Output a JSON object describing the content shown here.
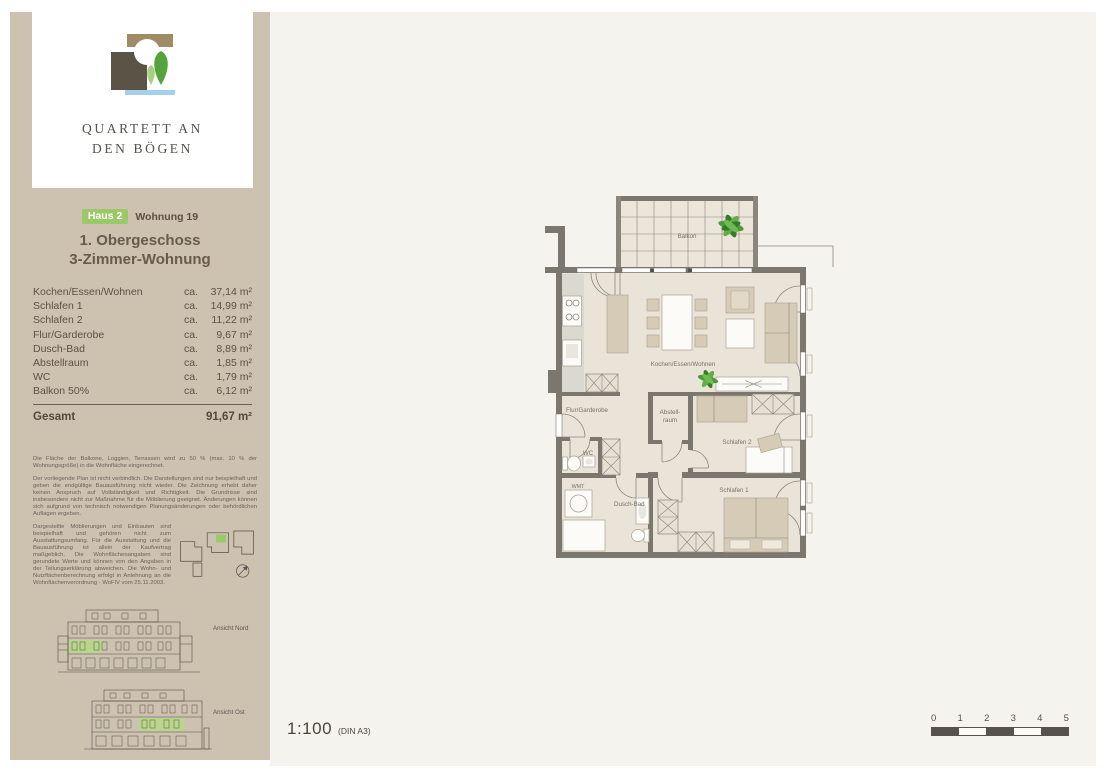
{
  "brand": {
    "name_line1": "QUARTETT AN",
    "name_line2": "DEN BÖGEN"
  },
  "header": {
    "house_badge": "Haus 2",
    "unit": "Wohnung 19",
    "floor": "1. Obergeschoss",
    "type": "3-Zimmer-Wohnung"
  },
  "area_table": {
    "rows": [
      {
        "label": "Kochen/Essen/Wohnen",
        "ca": "ca.",
        "value": "37,14 m²"
      },
      {
        "label": "Schlafen 1",
        "ca": "ca.",
        "value": "14,99 m²"
      },
      {
        "label": "Schlafen 2",
        "ca": "ca.",
        "value": "11,22 m²"
      },
      {
        "label": "Flur/Garderobe",
        "ca": "ca.",
        "value": "9,67 m²"
      },
      {
        "label": "Dusch-Bad",
        "ca": "ca.",
        "value": "8,89 m²"
      },
      {
        "label": "Abstellraum",
        "ca": "ca.",
        "value": "1,85 m²"
      },
      {
        "label": "WC",
        "ca": "ca.",
        "value": "1,79 m²"
      },
      {
        "label": "Balkon 50%",
        "ca": "ca.",
        "value": "6,12 m²"
      }
    ],
    "total_label": "Gesamt",
    "total_value": "91,67 m²"
  },
  "disclaimer": {
    "p1": "Die Fläche der Balkone, Loggien, Terrassen wird zu 50 % (max. 10 % der Wohnungsgröße) in die Wohnfläche eingerechnet.",
    "p2": "Der vorliegende Plan ist nicht verbindlich. Die Darstellungen sind nur beispielhaft und geben die endgültige Bauausführung nicht wieder. Die Zeichnung erhebt daher keinen Anspruch auf Vollständigkeit und Richtigkeit. Die Grundrisse sind insbesondere nicht zur Maßnahme für die Möblierung geeignet. Änderungen können sich aufgrund von technisch notwendigen Planungsänderungen oder behördlichen Auflagen ergeben.",
    "p3": "Dargestellte Möblierungen und Einbauten sind beispielhaft und gehören nicht zum Ausstattungsumfang. Für die Ausstattung und die Bauausführung ist allein der Kaufvertrag maßgeblich. Die Wohnflächenangaben sind gerundete Werte und können von den Angaben in der Teilungserklärung abweichen. Die Wohn- und Nutzflächenberechnung erfolgt in Anlehnung an die Wohnflächenverordnung - WoFlV vom 25.11.2003."
  },
  "elevations": {
    "north": "Ansicht Nord",
    "east": "Ansicht Ost"
  },
  "plan": {
    "labels": {
      "balkon": "Balkon",
      "living": "Kochen/Essen/Wohnen",
      "flur": "Flur/Garderobe",
      "abstell1": "Abstell-",
      "abstell2": "raum",
      "schlafen2": "Schlafen 2",
      "schlafen1": "Schlafen 1",
      "wc": "WC",
      "wmt": "WMT",
      "bad": "Dusch-Bad"
    }
  },
  "scale": {
    "ratio": "1:100",
    "sheet": "(DIN A3)",
    "ticks": [
      "0",
      "1",
      "2",
      "3",
      "4",
      "5"
    ]
  },
  "colors": {
    "sidebar_tan": "#cdc1b0",
    "badge_green": "#9cc968",
    "highlight_green": "#b9d68c",
    "wall_gray": "#7b766e",
    "floor_beige": "#eae3d8",
    "main_bg": "#f5f3ee"
  }
}
